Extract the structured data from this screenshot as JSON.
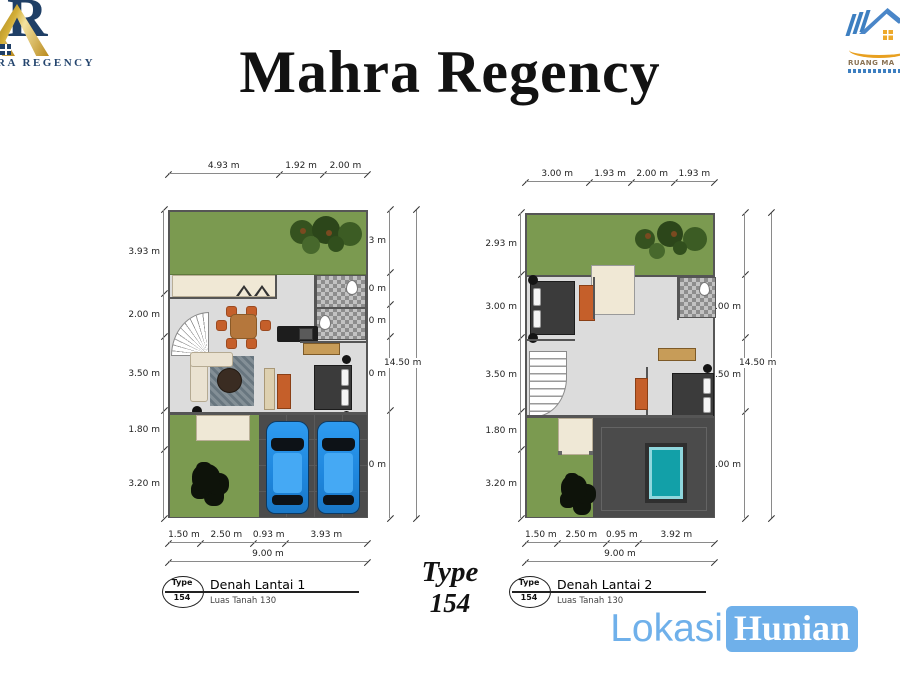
{
  "title": "Mahra Regency",
  "logo_left": {
    "brand_text": "RA REGENCY"
  },
  "logo_right": {
    "brand_text": "RUANG MA"
  },
  "type_caption": {
    "line1": "Type",
    "line2": "154"
  },
  "watermark": {
    "part1": "Lokasi",
    "part2": "Hunian"
  },
  "colors": {
    "watermark_blue": "#6fb0ea",
    "lawn_green": "#7b9a50",
    "carport_gray": "#4b4b4b",
    "pool_teal": "#12a0a8",
    "car_blue": "#2493ea",
    "logo_gold": "#d4af37",
    "logo_navy": "#1f3f66",
    "accent_orange": "#c55f2a"
  },
  "plans": [
    {
      "name": "Denah Lantai 1",
      "area_label": "Luas Tanah 130",
      "badge": {
        "top": "Type",
        "bottom": "154"
      },
      "dims": {
        "top": [
          "4.93 m",
          "1.92 m",
          "2.00 m"
        ],
        "left": [
          "3.93 m",
          "2.00 m",
          "3.50 m",
          "1.80 m",
          "3.20 m"
        ],
        "right": [
          "2.93 m",
          "1.50 m",
          "1.50 m",
          "3.50 m",
          "5.00 m"
        ],
        "right_total": "14.50 m",
        "bottom": [
          "1.50 m",
          "2.50 m",
          "0.93 m",
          "3.93 m"
        ],
        "bottom_total": "9.00 m"
      }
    },
    {
      "name": "Denah Lantai 2",
      "area_label": "Luas Tanah 130",
      "badge": {
        "top": "Type",
        "bottom": "154"
      },
      "dims": {
        "top": [
          "3.00 m",
          "1.93 m",
          "2.00 m",
          "1.93 m"
        ],
        "left": [
          "2.93 m",
          "3.00 m",
          "3.50 m",
          "1.80 m",
          "3.20 m"
        ],
        "right": [
          "",
          "3.00 m",
          "3.50 m",
          "5.00 m"
        ],
        "right_total": "14.50 m",
        "bottom": [
          "1.50 m",
          "2.50 m",
          "0.95 m",
          "3.92 m"
        ],
        "bottom_total": "9.00 m"
      }
    }
  ]
}
